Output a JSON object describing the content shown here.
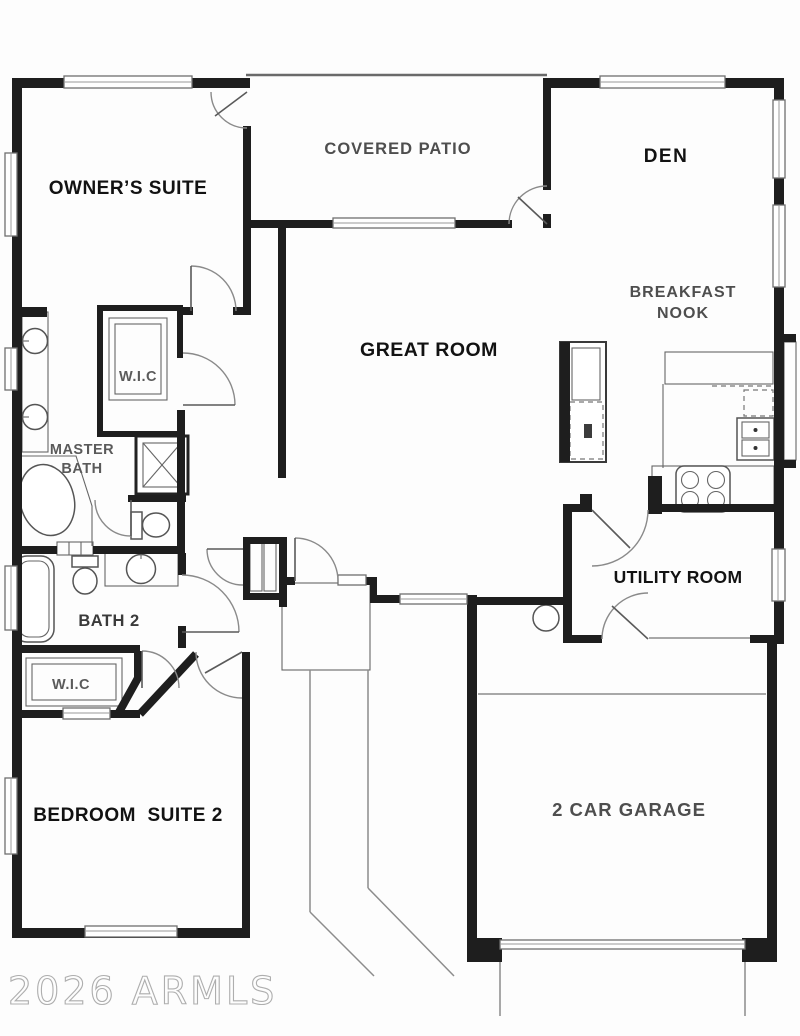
{
  "plan": {
    "type": "residential-floor-plan",
    "rooms": {
      "owners_suite": {
        "label": "OWNER’S SUITE"
      },
      "covered_patio": {
        "label": "COVERED PATIO"
      },
      "den": {
        "label": "DEN"
      },
      "breakfast_nook": {
        "line1": "BREAKFAST",
        "line2": "NOOK"
      },
      "great_room": {
        "label": "GREAT ROOM"
      },
      "master_wic": {
        "label": "W.I.C"
      },
      "master_bath": {
        "line1": "MASTER",
        "line2": "BATH"
      },
      "bath2": {
        "label": "BATH 2"
      },
      "bedroom_wic": {
        "label": "W.I.C"
      },
      "utility": {
        "label": "UTILITY ROOM"
      },
      "bedroom2": {
        "label": "BEDROOM  SUITE 2"
      },
      "garage": {
        "label": "2 CAR GARAGE"
      }
    },
    "fixtures": [
      "bathtub-master",
      "shower-master",
      "toilet-master",
      "double-sink-vanity",
      "linen-closet",
      "bathtub-2",
      "toilet-2",
      "sink-vanity-2",
      "closet-shelves",
      "coat-closet-bifold",
      "refrigerator-pantry-column",
      "kitchen-counter",
      "double-oven",
      "cooktop",
      "water-heater",
      "garage-door",
      "front-door",
      "entry-walkway"
    ]
  },
  "watermark": {
    "text": "2026 ARMLS"
  },
  "colors": {
    "wall": "#1e1e1e",
    "label_dark": "#121212",
    "label_gray": "#4e4e4e",
    "watermark_stroke": "#aeaeae",
    "background": "#fdfdfd"
  }
}
